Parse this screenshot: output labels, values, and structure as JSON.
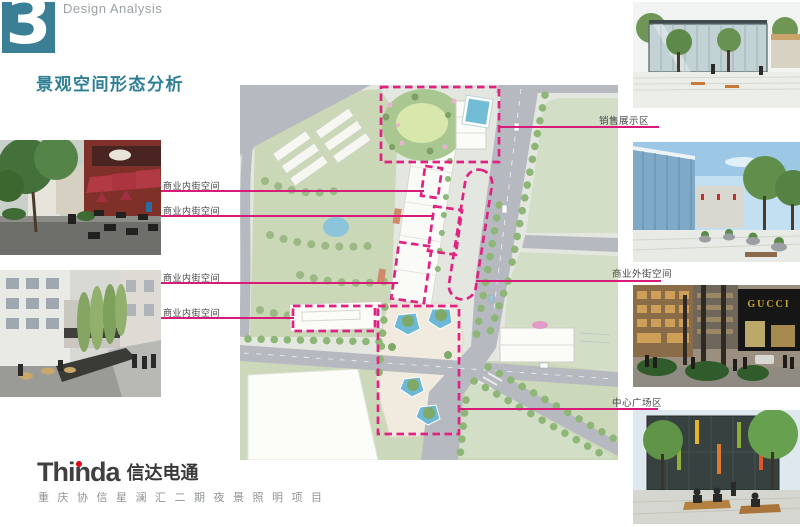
{
  "slide": {
    "section_number": "3",
    "section_label": "Design Analysis",
    "title": "景观空间形态分析"
  },
  "colors": {
    "accent_teal": "#3a7f96",
    "annotation_pink": "#d81b78",
    "dashed_zone_pink": "#e02382"
  },
  "annotations": {
    "inner_street_labels": [
      "商业内街空间",
      "商业内街空间",
      "商业内街空间",
      "商业内街空间"
    ],
    "sales_area_label": "销售展示区",
    "outer_street_label": "商业外街空间",
    "central_plaza_label": "中心广场区"
  },
  "photos": {
    "gucci_sign": "GUCCI"
  },
  "footer": {
    "logo_latin": "Thinda",
    "logo_cn": "信达电通",
    "project_name": "重庆协信星澜汇二期夜景照明项目"
  }
}
